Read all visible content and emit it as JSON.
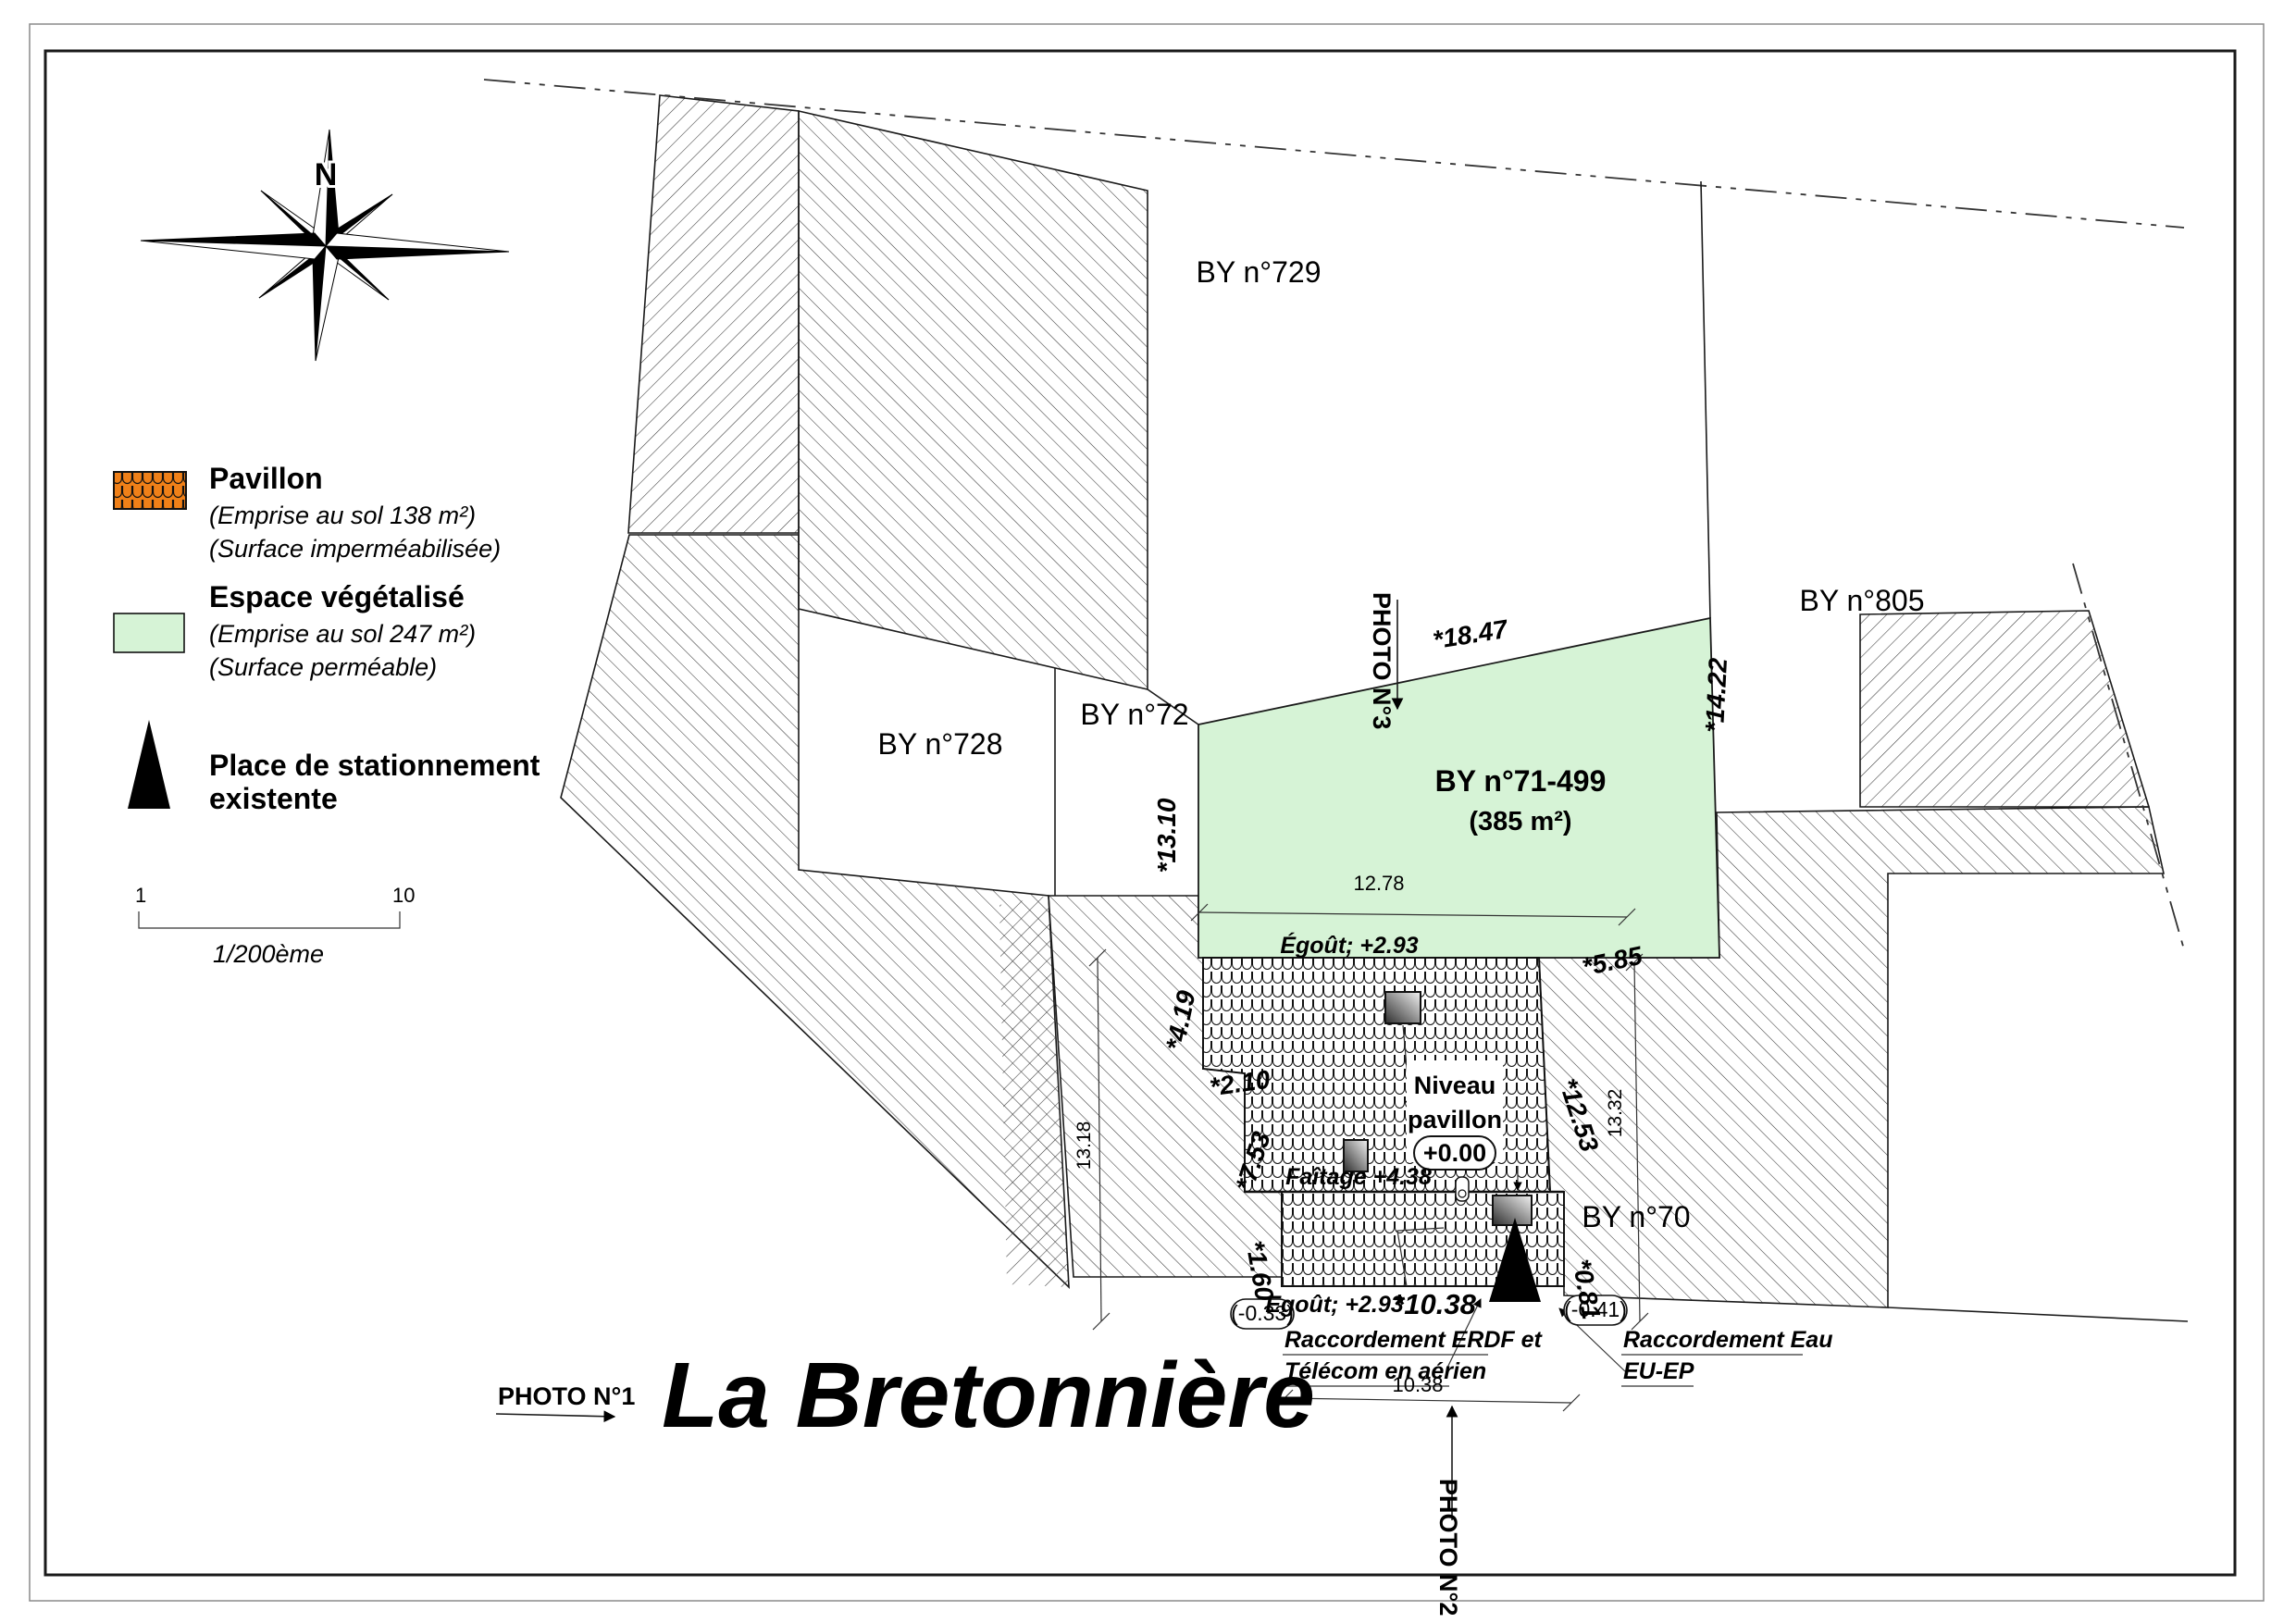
{
  "title": "La Bretonnière",
  "compass": {
    "north": "N"
  },
  "legend": {
    "pavillon": {
      "title": "Pavillon",
      "line1": "(Emprise au sol 138 m²)",
      "line2": "(Surface imperméabilisée)"
    },
    "espace": {
      "title": "Espace végétalisé",
      "line1": "(Emprise au sol 247 m²)",
      "line2": "(Surface perméable)"
    },
    "parking": {
      "line1": "Place de stationnement",
      "line2": "existente"
    }
  },
  "scalebar": {
    "start": "1",
    "end": "10",
    "ratio": "1/200ème"
  },
  "parcels": {
    "by729": "BY n°729",
    "by728": "BY n°728",
    "by72": "BY n°72",
    "by805": "BY n°805",
    "by70": "BY n°70",
    "main": "BY n°71-499",
    "main_area": "(385 m²)"
  },
  "levels": {
    "niveau1": "Niveau",
    "niveau2": "pavillon",
    "niveau_val": "+0.00",
    "egout_top": "Égoût; +2.93",
    "egout_bottom": "Egoût; +2.93",
    "faitage": "Faîtage +4.38",
    "neg_left": "(-0.33)",
    "neg_right": "(-0.41)"
  },
  "dims": {
    "d1847": "*18.47",
    "d1422": "*14.22",
    "d1310": "*13.10",
    "d1278": "12.78",
    "d585": "*5.85",
    "d419": "*4.19",
    "d210": "*2.10",
    "d753": "*7.53",
    "d1253": "*12.53",
    "d1332": "13.32",
    "d1318": "13.18",
    "d160": "*1.60",
    "d081": "*0.81",
    "d1038_star": "*10.38",
    "d1038": "10.38"
  },
  "photos": {
    "p1": "PHOTO N°1",
    "p2": "PHOTO N°2",
    "p3": "PHOTO N°3"
  },
  "raccord": {
    "erdf1": "Raccordement ERDF et",
    "erdf2": "Télécom en aérien",
    "eau1": "Raccordement Eau",
    "eau2": "EU-EP"
  },
  "colors": {
    "green": "#d6f3d6",
    "orange": "#f08018"
  }
}
